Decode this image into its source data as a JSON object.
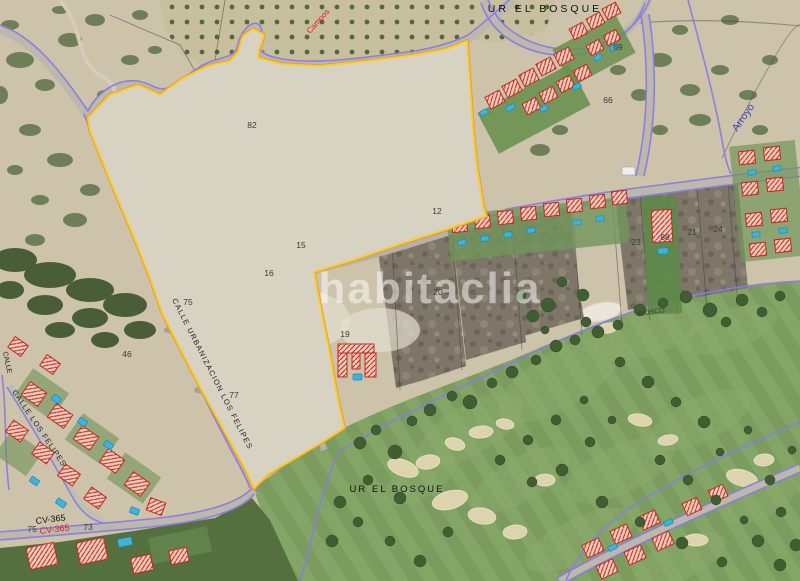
{
  "map": {
    "watermark": "habitaclia",
    "region_labels": {
      "urbanization_top": "UR EL BOSQUE",
      "urbanization_golf": "UR EL BOSQUE",
      "kiosco": "KIOSCO",
      "arroyo": "Arroyo"
    },
    "street_labels": {
      "calle_urbanizacion": "CALLE URBANIZACION LOS FELIPES",
      "calle_felipes": "CALLE LOS FELIPES",
      "calle_left": "CALLE",
      "road_code_black": "CV-365",
      "road_code_red": "CV-365",
      "campos": "Campos"
    },
    "parcel_numbers": [
      {
        "value": "82",
        "x": 252,
        "y": 128
      },
      {
        "value": "12",
        "x": 437,
        "y": 214
      },
      {
        "value": "15",
        "x": 301,
        "y": 248
      },
      {
        "value": "16",
        "x": 269,
        "y": 276
      },
      {
        "value": "75",
        "x": 188,
        "y": 305
      },
      {
        "value": "77",
        "x": 234,
        "y": 398
      },
      {
        "value": "19",
        "x": 345,
        "y": 337
      },
      {
        "value": "20",
        "x": 438,
        "y": 295
      },
      {
        "value": "46",
        "x": 127,
        "y": 357
      },
      {
        "value": "73",
        "x": 88,
        "y": 530
      },
      {
        "value": "75",
        "x": 32,
        "y": 532
      },
      {
        "value": "23",
        "x": 636,
        "y": 245
      },
      {
        "value": "88",
        "x": 665,
        "y": 240
      },
      {
        "value": "21",
        "x": 692,
        "y": 235
      },
      {
        "value": "24",
        "x": 718,
        "y": 232
      },
      {
        "value": "66",
        "x": 608,
        "y": 103
      },
      {
        "value": "69",
        "x": 618,
        "y": 50
      }
    ],
    "colors": {
      "parcel_boundary_yellow": "#F7CE2E",
      "parcel_boundary_orange": "#E59B35",
      "cadastral_purple": "#8B7CE0",
      "building_outline_red": "#C5291C",
      "pool_blue": "#3FB3DC",
      "road_label_red": "#E02018",
      "stream_label_blue": "#3C3CCC",
      "golf_green": "#7B9C5E",
      "terrain_tan": "#CDC3AB",
      "watermark_white": "#FFFFFF"
    }
  }
}
